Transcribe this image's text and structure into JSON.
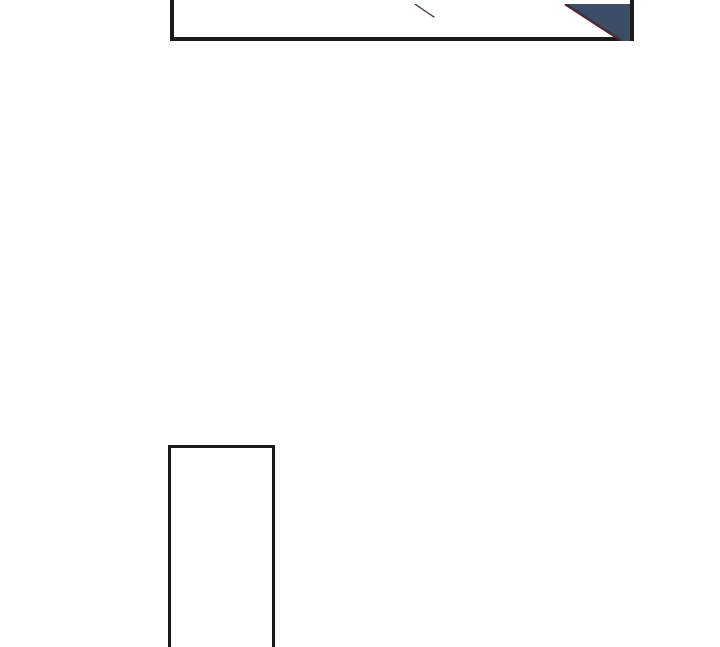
{
  "page": {
    "background_color": "#ffffff",
    "kind": "comic-page-fragment"
  },
  "colors": {
    "panel_border": "#1b1b1b",
    "panel_fill": "#ffffff",
    "corner_triangle_fill": "#3d4d68",
    "corner_triangle_edge": "#4e2b33",
    "sketch_line": "#55414a"
  },
  "panels": {
    "top": {
      "id": "top-panel",
      "cropped_edge": "top"
    },
    "bottom": {
      "id": "bottom-panel",
      "cropped_edge": "bottom"
    }
  }
}
